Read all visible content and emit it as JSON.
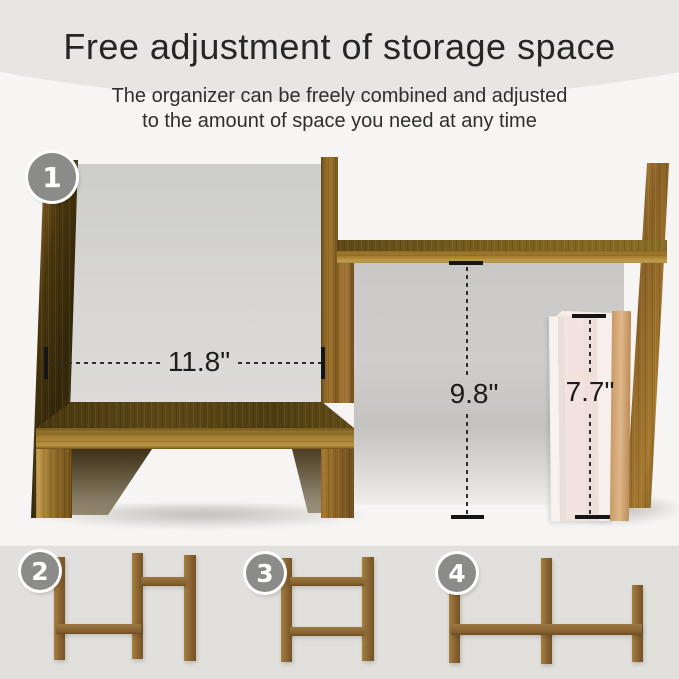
{
  "header": {
    "title": "Free adjustment of storage space",
    "subtitle_line1": "The organizer can be freely combined and adjusted",
    "subtitle_line2": "to the amount of space you need at any time"
  },
  "badges": {
    "step1": "1",
    "step2": "2",
    "step3": "3",
    "step4": "4"
  },
  "dimensions": {
    "width": "11.8\"",
    "height": "9.8\"",
    "book_height": "7.7\""
  },
  "colors": {
    "bg-outer": "#e8e6e3",
    "bg-card": "#f6f5f3",
    "bg-bottom": "#e2e0dd",
    "title-text": "#262626",
    "dim-text": "#1c1c1c",
    "badge-gray": "#8b8b89",
    "wood-light": "#b08344",
    "wood-mid": "#8a6228",
    "wood-dark": "#53400f",
    "cavity-gray": "#d2d1cf",
    "book-cream": "#f4e9e4",
    "book-tan": "#d0a172"
  }
}
